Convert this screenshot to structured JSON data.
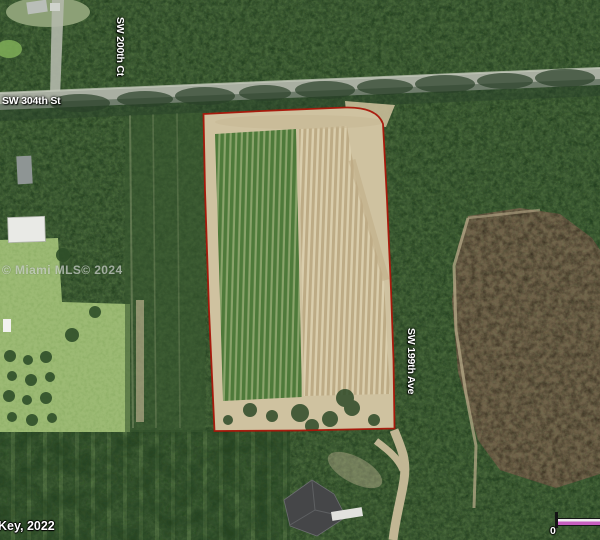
{
  "map": {
    "labels": {
      "road_horizontal": "SW 304th St",
      "road_vertical_left": "SW 200th Ct",
      "road_vertical_right": "SW 199th Ave"
    },
    "watermark": "© Miami MLS© 2024",
    "imagery_credit": "Key, 2022",
    "scale_bar": {
      "zero_label": "0"
    },
    "colors": {
      "parcel_boundary": "#a81508",
      "scale_bar_fill": "#c75fc0"
    }
  }
}
